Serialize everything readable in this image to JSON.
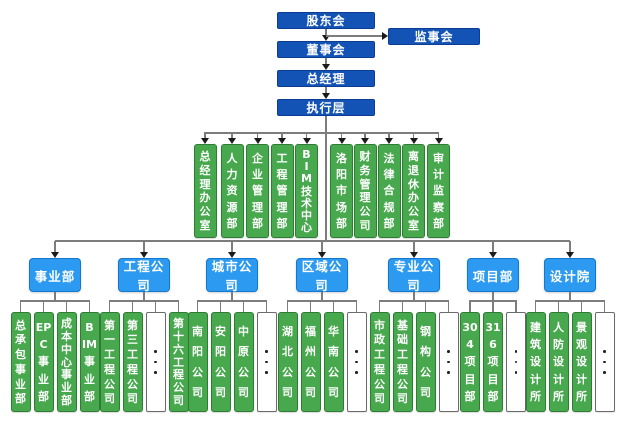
{
  "colors": {
    "primary_box_blue": "#1353b5",
    "secondary_box_blue": "#2b9af0",
    "unit_box_green": "#47a84d",
    "connector_gray": "#7d7d7d",
    "arrow_black": "#1a1a1a"
  },
  "top_chain": [
    {
      "name": "shareholders-meeting",
      "label": "股东会"
    },
    {
      "name": "board-of-directors",
      "label": "董事会"
    },
    {
      "name": "general-manager",
      "label": "总经理"
    },
    {
      "name": "executive-layer",
      "label": "执行层"
    }
  ],
  "supervisory_board": {
    "name": "supervisory-board",
    "label": "监事会"
  },
  "departments": [
    {
      "name": "general-manager-office",
      "label": "总经理办公室",
      "lines": [
        "总",
        "经",
        "理",
        "办",
        "公",
        "室"
      ]
    },
    {
      "name": "human-resources-dept",
      "label": "人力资源部",
      "lines": [
        "人",
        "力",
        "资",
        "源",
        "部"
      ]
    },
    {
      "name": "enterprise-management-dept",
      "label": "企业管理部",
      "lines": [
        "企",
        "业",
        "管",
        "理",
        "部"
      ]
    },
    {
      "name": "engineering-management-dept",
      "label": "工程管理部",
      "lines": [
        "工",
        "程",
        "管",
        "理",
        "部"
      ]
    },
    {
      "name": "bim-technology-center",
      "label": "BIM技术中心",
      "lines": [
        "B",
        "I",
        "M",
        "技",
        "术",
        "中",
        "心"
      ]
    },
    {
      "name": "luoyang-market-dept",
      "label": "洛阳市场部",
      "lines": [
        "洛",
        "阳",
        "市",
        "场",
        "部"
      ]
    },
    {
      "name": "finance-management-company",
      "label": "财务管理公司",
      "lines": [
        "财",
        "务",
        "管",
        "理",
        "公",
        "司"
      ]
    },
    {
      "name": "legal-compliance-dept",
      "label": "法律合规部",
      "lines": [
        "法",
        "律",
        "合",
        "规",
        "部"
      ]
    },
    {
      "name": "retirees-office",
      "label": "离退休办公室",
      "lines": [
        "离",
        "退",
        "休",
        "办",
        "公",
        "室"
      ]
    },
    {
      "name": "audit-supervision-dept",
      "label": "审计监察部",
      "lines": [
        "审",
        "计",
        "监",
        "察",
        "部"
      ]
    }
  ],
  "divisions": [
    {
      "name": "business-division",
      "label": "事业部",
      "children": [
        {
          "type": "unit",
          "name": "general-contracting-division",
          "label": "总承包事业部",
          "lines": [
            "总",
            "承",
            "包",
            "事",
            "业",
            "部"
          ]
        },
        {
          "type": "unit",
          "name": "epc-division",
          "label": "EPC事业部",
          "lines": [
            "EP",
            "C",
            "事",
            "业",
            "部"
          ]
        },
        {
          "type": "unit",
          "name": "cost-center-division",
          "label": "成本中心事业部",
          "lines": [
            "成",
            "本",
            "中",
            "心",
            "事",
            "业",
            "部"
          ]
        },
        {
          "type": "unit",
          "name": "bim-division",
          "label": "BIM事业部",
          "lines": [
            "B",
            "IM",
            "事",
            "业",
            "部"
          ]
        }
      ]
    },
    {
      "name": "engineering-companies",
      "label": "工程公司",
      "children": [
        {
          "type": "unit",
          "name": "no1-engineering-company",
          "label": "第一工程公司",
          "lines": [
            "第",
            "一",
            "工",
            "程",
            "公",
            "司"
          ]
        },
        {
          "type": "unit",
          "name": "no3-engineering-company",
          "label": "第三工程公司",
          "lines": [
            "第",
            "三",
            "工",
            "程",
            "公",
            "司"
          ]
        },
        {
          "type": "more",
          "name": "more-engineering-companies"
        },
        {
          "type": "unit",
          "name": "no16-engineering-company",
          "label": "第十六工程公司",
          "lines": [
            "第",
            "十",
            "六",
            "工",
            "程",
            "公",
            "司"
          ]
        }
      ]
    },
    {
      "name": "city-companies",
      "label": "城市公司",
      "children": [
        {
          "type": "unit",
          "name": "nanyang-company",
          "label": "南阳公司",
          "lines": [
            "南",
            "阳",
            "公",
            "司"
          ]
        },
        {
          "type": "unit",
          "name": "anyang-company",
          "label": "安阳公司",
          "lines": [
            "安",
            "阳",
            "公",
            "司"
          ]
        },
        {
          "type": "unit",
          "name": "zhongyuan-company",
          "label": "中原公司",
          "lines": [
            "中",
            "原",
            "公",
            "司"
          ]
        },
        {
          "type": "more",
          "name": "more-city-companies"
        }
      ]
    },
    {
      "name": "regional-companies",
      "label": "区域公司",
      "children": [
        {
          "type": "unit",
          "name": "hubei-company",
          "label": "湖北公司",
          "lines": [
            "湖",
            "北",
            "公",
            "司"
          ]
        },
        {
          "type": "unit",
          "name": "fuzhou-company",
          "label": "福州公司",
          "lines": [
            "福",
            "州",
            "公",
            "司"
          ]
        },
        {
          "type": "unit",
          "name": "south-china-company",
          "label": "华南公司",
          "lines": [
            "华",
            "南",
            "公",
            "司"
          ]
        },
        {
          "type": "more",
          "name": "more-regional-companies"
        }
      ]
    },
    {
      "name": "specialty-companies",
      "label": "专业公司",
      "children": [
        {
          "type": "unit",
          "name": "municipal-engineering-company",
          "label": "市政工程公司",
          "lines": [
            "市",
            "政",
            "工",
            "程",
            "公",
            "司"
          ]
        },
        {
          "type": "unit",
          "name": "foundation-engineering-company",
          "label": "基础工程公司",
          "lines": [
            "基",
            "础",
            "工",
            "程",
            "公",
            "司"
          ]
        },
        {
          "type": "unit",
          "name": "steel-structure-company",
          "label": "钢构公司",
          "lines": [
            "钢",
            "构",
            "公",
            "司"
          ]
        },
        {
          "type": "more",
          "name": "more-specialty-companies"
        }
      ]
    },
    {
      "name": "project-departments",
      "label": "项目部",
      "children": [
        {
          "type": "unit",
          "name": "project-304",
          "label": "304项目部",
          "lines": [
            "30",
            "4",
            "项",
            "目",
            "部"
          ]
        },
        {
          "type": "unit",
          "name": "project-316",
          "label": "316项目部",
          "lines": [
            "31",
            "6",
            "项",
            "目",
            "部"
          ]
        },
        {
          "type": "more",
          "name": "more-project-departments"
        }
      ]
    },
    {
      "name": "design-institute",
      "label": "设计院",
      "children": [
        {
          "type": "unit",
          "name": "architectural-design-studio",
          "label": "建筑设计所",
          "lines": [
            "建",
            "筑",
            "设",
            "计",
            "所"
          ]
        },
        {
          "type": "unit",
          "name": "civil-defense-design-studio",
          "label": "人防设计所",
          "lines": [
            "人",
            "防",
            "设",
            "计",
            "所"
          ]
        },
        {
          "type": "unit",
          "name": "landscape-design-studio",
          "label": "景观设计所",
          "lines": [
            "景",
            "观",
            "设",
            "计",
            "所"
          ]
        },
        {
          "type": "more",
          "name": "more-design-studios"
        }
      ]
    }
  ]
}
